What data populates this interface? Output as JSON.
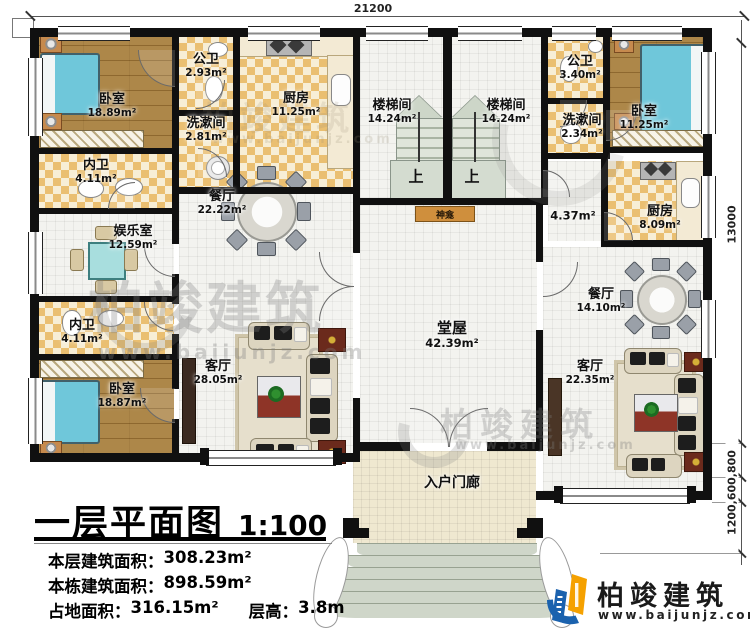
{
  "plan": {
    "dimensions": {
      "top_width": "21200",
      "right_height": "13000",
      "right_bottom_chain": "1200,600,800"
    },
    "rooms": {
      "bedroom_tl": {
        "label": "卧室",
        "area": "18.89m²"
      },
      "gongwei_l": {
        "label": "公卫",
        "area": "2.93m²"
      },
      "xishujian_l": {
        "label": "洗漱间",
        "area": "2.81m²"
      },
      "kitchen_l": {
        "label": "厨房",
        "area": "11.25m²"
      },
      "neiwei_1": {
        "label": "内卫",
        "area": "4.11m²"
      },
      "game_room": {
        "label": "娱乐室",
        "area": "12.59m²"
      },
      "dining_l": {
        "label": "餐厅",
        "area": "22.22m²"
      },
      "neiwei_2": {
        "label": "内卫",
        "area": "4.11m²"
      },
      "bedroom_bl": {
        "label": "卧室",
        "area": "18.87m²"
      },
      "living_l": {
        "label": "客厅",
        "area": "28.05m²"
      },
      "stair_l": {
        "label": "楼梯间",
        "area": "14.24m²"
      },
      "stair_r": {
        "label": "楼梯间",
        "area": "14.24m²"
      },
      "stair_up_l": {
        "label": "上"
      },
      "stair_up_r": {
        "label": "上"
      },
      "shrine": {
        "label": "神龛"
      },
      "hall": {
        "label": "堂屋",
        "area": "42.39m²"
      },
      "gongwei_r": {
        "label": "公卫",
        "area": "3.40m²"
      },
      "xishujian_r": {
        "label": "洗漱间",
        "area": "2.34m²"
      },
      "bedroom_tr": {
        "label": "卧室",
        "area": "11.25m²"
      },
      "corridor_r": {
        "area": "4.37m²"
      },
      "kitchen_r": {
        "label": "厨房",
        "area": "8.09m²"
      },
      "dining_r": {
        "label": "餐厅",
        "area": "14.10m²"
      },
      "living_r": {
        "label": "客厅",
        "area": "22.35m²"
      },
      "porch": {
        "label": "入户门廊"
      }
    }
  },
  "title_block": {
    "title": "一层平面图",
    "scale": "1:100",
    "rows": [
      {
        "label": "本层建筑面积：",
        "value": "308.23m²"
      },
      {
        "label": "本栋建筑面积：",
        "value": "898.59m²"
      },
      {
        "label": "占地面积：",
        "value": "316.15m²"
      },
      {
        "label": "层高：",
        "value": "3.8m"
      }
    ]
  },
  "brand": {
    "name": "柏竣建筑",
    "website": "www.baijunjz.com"
  },
  "watermark": {
    "text": "柏竣建筑",
    "url": "www.baijunjz.com"
  },
  "colors": {
    "accent_blue": "#1b62ae",
    "accent_orange": "#f5a100",
    "wall": "#101010",
    "bed": "#6fc7da",
    "tile_tan": "#eabf71"
  }
}
